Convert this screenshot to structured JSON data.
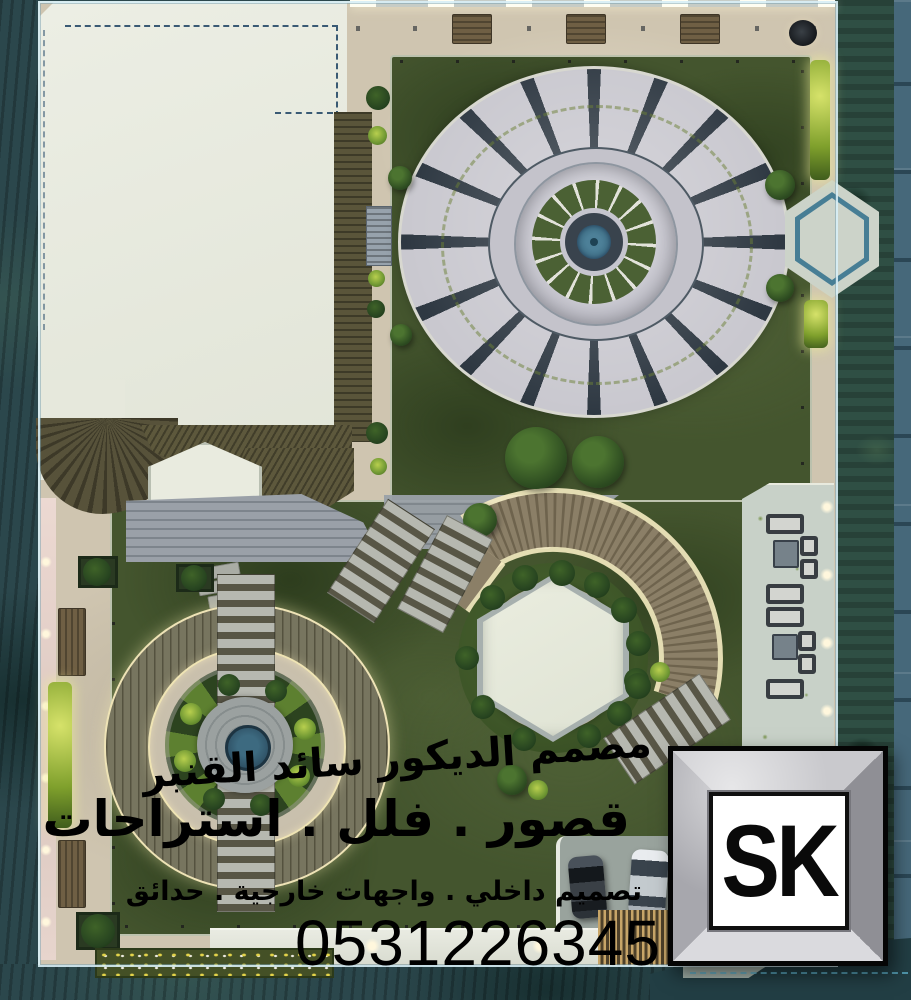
{
  "watermark": {
    "line1": "مصمم الديكور سائد القنبر",
    "line2": "قصور . فلل . استراحات",
    "line3": "تصميم داخلي . واجهات خارجية . حدائق",
    "phone": "0531226345"
  },
  "logo": {
    "text": "SK"
  },
  "palette": {
    "wall_teal": "#2b474c",
    "hedge_green": "#2f4f44",
    "panel_blue": "#46687a",
    "lawn_green": "#44552e",
    "walkway_beige": "#cfc5b0",
    "plaza_concrete": "#c9c8cf",
    "plaza_stripe": "#2e3842",
    "deck_wood": "#8b7f67",
    "water_teal": "#3f7088",
    "glow_warm": "#f6ecc2",
    "text_black": "#000000"
  }
}
